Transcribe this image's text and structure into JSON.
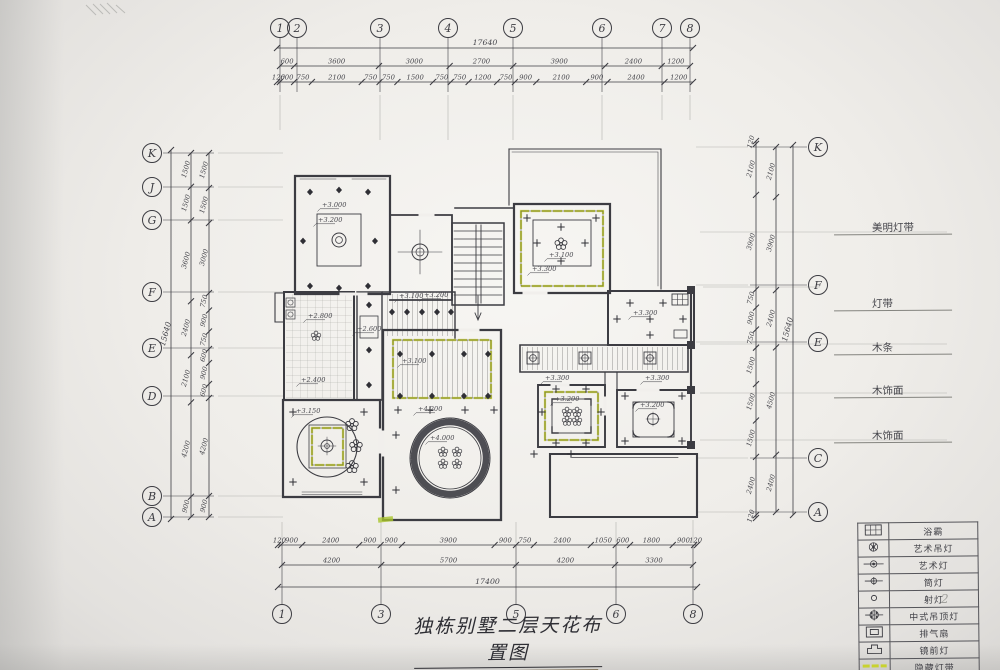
{
  "page": {
    "title": "独栋别墅二层天花布置图",
    "scale": "SC/ 1:100",
    "sheet_note": "2"
  },
  "colors": {
    "ink": "#3c3c42",
    "pencil": "#8a8a88",
    "highlight": "#c8d22f",
    "paper": "#f1efeb"
  },
  "axes": {
    "top": {
      "bubbles": [
        "1",
        "2",
        "3",
        "4",
        "5",
        "6",
        "7",
        "8"
      ],
      "total": "17640",
      "mid": [
        "600",
        "3600",
        "3000",
        "2700",
        "3900",
        "2400",
        "1200"
      ],
      "fine": [
        "120",
        "600",
        "750",
        "2100",
        "750",
        "750",
        "1500",
        "750",
        "750",
        "1200",
        "750",
        "900",
        "2100",
        "900",
        "2400",
        "1200"
      ]
    },
    "bottom": {
      "bubbles": [
        "1",
        "3",
        "5",
        "6",
        "8"
      ],
      "total": "17400",
      "mid": [
        "4200",
        "5700",
        "4200",
        "3300"
      ],
      "fine": [
        "120",
        "900",
        "2400",
        "900",
        "900",
        "3900",
        "900",
        "750",
        "2400",
        "1050",
        "600",
        "1800",
        "900",
        "120"
      ]
    },
    "left": {
      "bubbles": [
        "K",
        "J",
        "G",
        "F",
        "E",
        "D",
        "B",
        "A"
      ],
      "total": "15640",
      "mid": [
        "1500",
        "1500",
        "3600",
        "2400",
        "2100",
        "4200",
        "900"
      ],
      "fine": [
        "1500",
        "1500",
        "3000",
        "750",
        "900",
        "750",
        "600",
        "900",
        "600",
        "4200",
        "900"
      ]
    },
    "right": {
      "bubbles": [
        "K",
        "F",
        "E",
        "C",
        "A"
      ],
      "total": "15640",
      "mid": [
        "2100",
        "3900",
        "2400",
        "4500",
        "2400"
      ],
      "fine": [
        "120",
        "2100",
        "3900",
        "750",
        "900",
        "750",
        "1500",
        "1500",
        "1500",
        "2400",
        "120"
      ]
    }
  },
  "side_labels": [
    "美明灯带",
    "灯带",
    "木条",
    "木饰面",
    "木饰面"
  ],
  "legend": {
    "rows": [
      {
        "icon": "yuba",
        "label": "浴霸"
      },
      {
        "icon": "art-pendant",
        "label": "艺术吊灯"
      },
      {
        "icon": "art-lamp",
        "label": "艺术灯"
      },
      {
        "icon": "downlight",
        "label": "筒灯"
      },
      {
        "icon": "spotlight",
        "label": "射灯"
      },
      {
        "icon": "chinese-ceiling-lamp",
        "label": "中式吊顶灯"
      },
      {
        "icon": "exhaust-fan",
        "label": "排气扇"
      },
      {
        "icon": "mirror-lamp",
        "label": "镜前灯"
      },
      {
        "icon": "hidden-light-strip",
        "label": "隐藏灯带"
      }
    ]
  },
  "levels": [
    "+3.000",
    "+3.200",
    "+3.100",
    "+3.300",
    "+3.300",
    "+2.800",
    "+2.400",
    "+3.150",
    "+4.200",
    "+4.000",
    "+3.200",
    "+3.200",
    "+2.600",
    "+3.100",
    "+3.200",
    "+3.300",
    "+3.300",
    "+3.100"
  ]
}
